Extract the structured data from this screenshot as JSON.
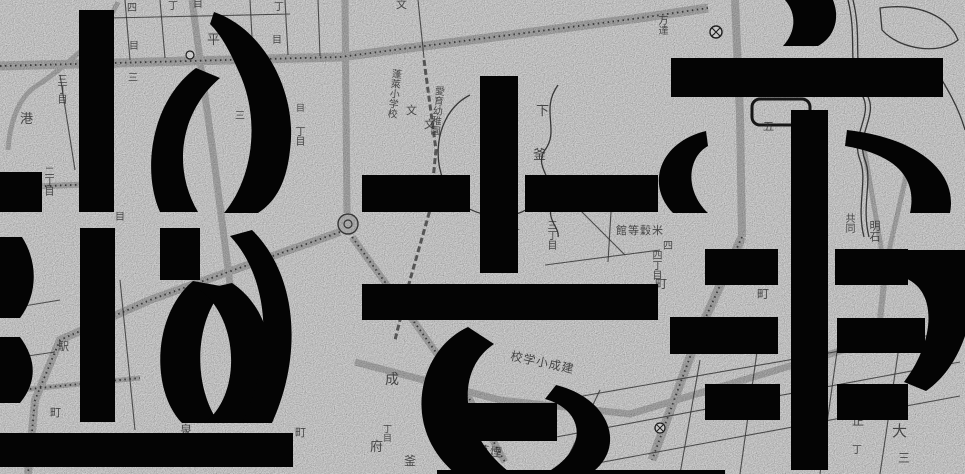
{
  "artwork": {
    "description": "Large black stencil-style geometric glyph shapes overlaid on a grayscale vintage Japanese city map",
    "colors": {
      "map_background": "#d2d2d2",
      "road_gray": "#a9a9a9",
      "line_ink": "#2e2e2e",
      "glyph_black": "#040404"
    }
  },
  "map": {
    "symbols": [
      {
        "name": "roundabout-plaza",
        "x": 348,
        "y": 224
      },
      {
        "name": "station-circle-marker",
        "x": 716,
        "y": 32
      },
      {
        "name": "circle-marker",
        "x": 660,
        "y": 428
      },
      {
        "name": "small-circle-marker",
        "x": 190,
        "y": 55
      }
    ],
    "labels": [
      {
        "t": "丁",
        "x": 168,
        "y": 2,
        "s": 10
      },
      {
        "t": "目",
        "x": 193,
        "y": 0,
        "s": 10
      },
      {
        "t": "四",
        "x": 127,
        "y": 4,
        "s": 10
      },
      {
        "t": "丁",
        "x": 274,
        "y": 3,
        "s": 10
      },
      {
        "t": "目",
        "x": 272,
        "y": 36,
        "s": 10
      },
      {
        "t": "平",
        "x": 207,
        "y": 33,
        "s": 13
      },
      {
        "t": "目",
        "x": 129,
        "y": 42,
        "s": 10
      },
      {
        "t": "三",
        "x": 128,
        "y": 74,
        "s": 10
      },
      {
        "t": "三丁目",
        "x": 55,
        "y": 74,
        "s": 10,
        "v": 1
      },
      {
        "t": "港",
        "x": 20,
        "y": 112,
        "s": 13
      },
      {
        "t": "二丁目",
        "x": 42,
        "y": 166,
        "s": 10,
        "v": 1
      },
      {
        "t": "目",
        "x": 115,
        "y": 213,
        "s": 10
      },
      {
        "t": "三",
        "x": 235,
        "y": 112,
        "s": 10
      },
      {
        "t": "丁目",
        "x": 293,
        "y": 126,
        "s": 10,
        "v": 1
      },
      {
        "t": "目",
        "x": 296,
        "y": 104,
        "s": 9
      },
      {
        "t": "文",
        "x": 396,
        "y": 0,
        "s": 11
      },
      {
        "t": "蓬萊小学校",
        "x": 390,
        "y": 68,
        "s": 10,
        "v": 1,
        "r": 6
      },
      {
        "t": "文",
        "x": 406,
        "y": 106,
        "s": 11
      },
      {
        "t": "文",
        "x": 424,
        "y": 120,
        "s": 11
      },
      {
        "t": "愛育幼稚園",
        "x": 433,
        "y": 85,
        "s": 10,
        "v": 1,
        "r": 6
      },
      {
        "t": "下",
        "x": 536,
        "y": 104,
        "s": 13
      },
      {
        "t": "釜",
        "x": 533,
        "y": 148,
        "s": 13
      },
      {
        "t": "三丁目",
        "x": 545,
        "y": 220,
        "s": 10,
        "v": 1
      },
      {
        "t": "丁",
        "x": 510,
        "y": 230,
        "s": 10
      },
      {
        "t": "館等穀米",
        "x": 616,
        "y": 226,
        "s": 11
      },
      {
        "t": "四丁目",
        "x": 650,
        "y": 250,
        "s": 10,
        "v": 1
      },
      {
        "t": "万達",
        "x": 656,
        "y": 15,
        "s": 10,
        "v": 1
      },
      {
        "t": "五",
        "x": 763,
        "y": 122,
        "s": 11
      },
      {
        "t": "共同",
        "x": 843,
        "y": 213,
        "s": 10,
        "v": 1
      },
      {
        "t": "明石",
        "x": 868,
        "y": 220,
        "s": 11,
        "v": 1
      },
      {
        "t": "駅",
        "x": 58,
        "y": 342,
        "s": 11
      },
      {
        "t": "町",
        "x": 50,
        "y": 408,
        "s": 11
      },
      {
        "t": "目",
        "x": 105,
        "y": 282,
        "s": 10
      },
      {
        "t": "丁目",
        "x": 157,
        "y": 250,
        "s": 10,
        "v": 1
      },
      {
        "t": "泉",
        "x": 180,
        "y": 424,
        "s": 12
      },
      {
        "t": "町",
        "x": 295,
        "y": 428,
        "s": 11
      },
      {
        "t": "成",
        "x": 385,
        "y": 372,
        "s": 14
      },
      {
        "t": "府",
        "x": 370,
        "y": 440,
        "s": 13
      },
      {
        "t": "釜",
        "x": 404,
        "y": 455,
        "s": 12
      },
      {
        "t": "丁目",
        "x": 382,
        "y": 424,
        "s": 9,
        "v": 1
      },
      {
        "t": "校学小成建",
        "x": 512,
        "y": 350,
        "s": 12,
        "r": 12
      },
      {
        "t": "場工草煙",
        "x": 452,
        "y": 440,
        "s": 12,
        "r": 8
      },
      {
        "t": "四",
        "x": 663,
        "y": 242,
        "s": 10
      },
      {
        "t": "町",
        "x": 655,
        "y": 278,
        "s": 12
      },
      {
        "t": "町",
        "x": 757,
        "y": 288,
        "s": 12
      },
      {
        "t": "正",
        "x": 852,
        "y": 415,
        "s": 12
      },
      {
        "t": "大",
        "x": 892,
        "y": 424,
        "s": 15
      },
      {
        "t": "三",
        "x": 898,
        "y": 452,
        "s": 12
      },
      {
        "t": "丁",
        "x": 852,
        "y": 446,
        "s": 10
      }
    ]
  }
}
